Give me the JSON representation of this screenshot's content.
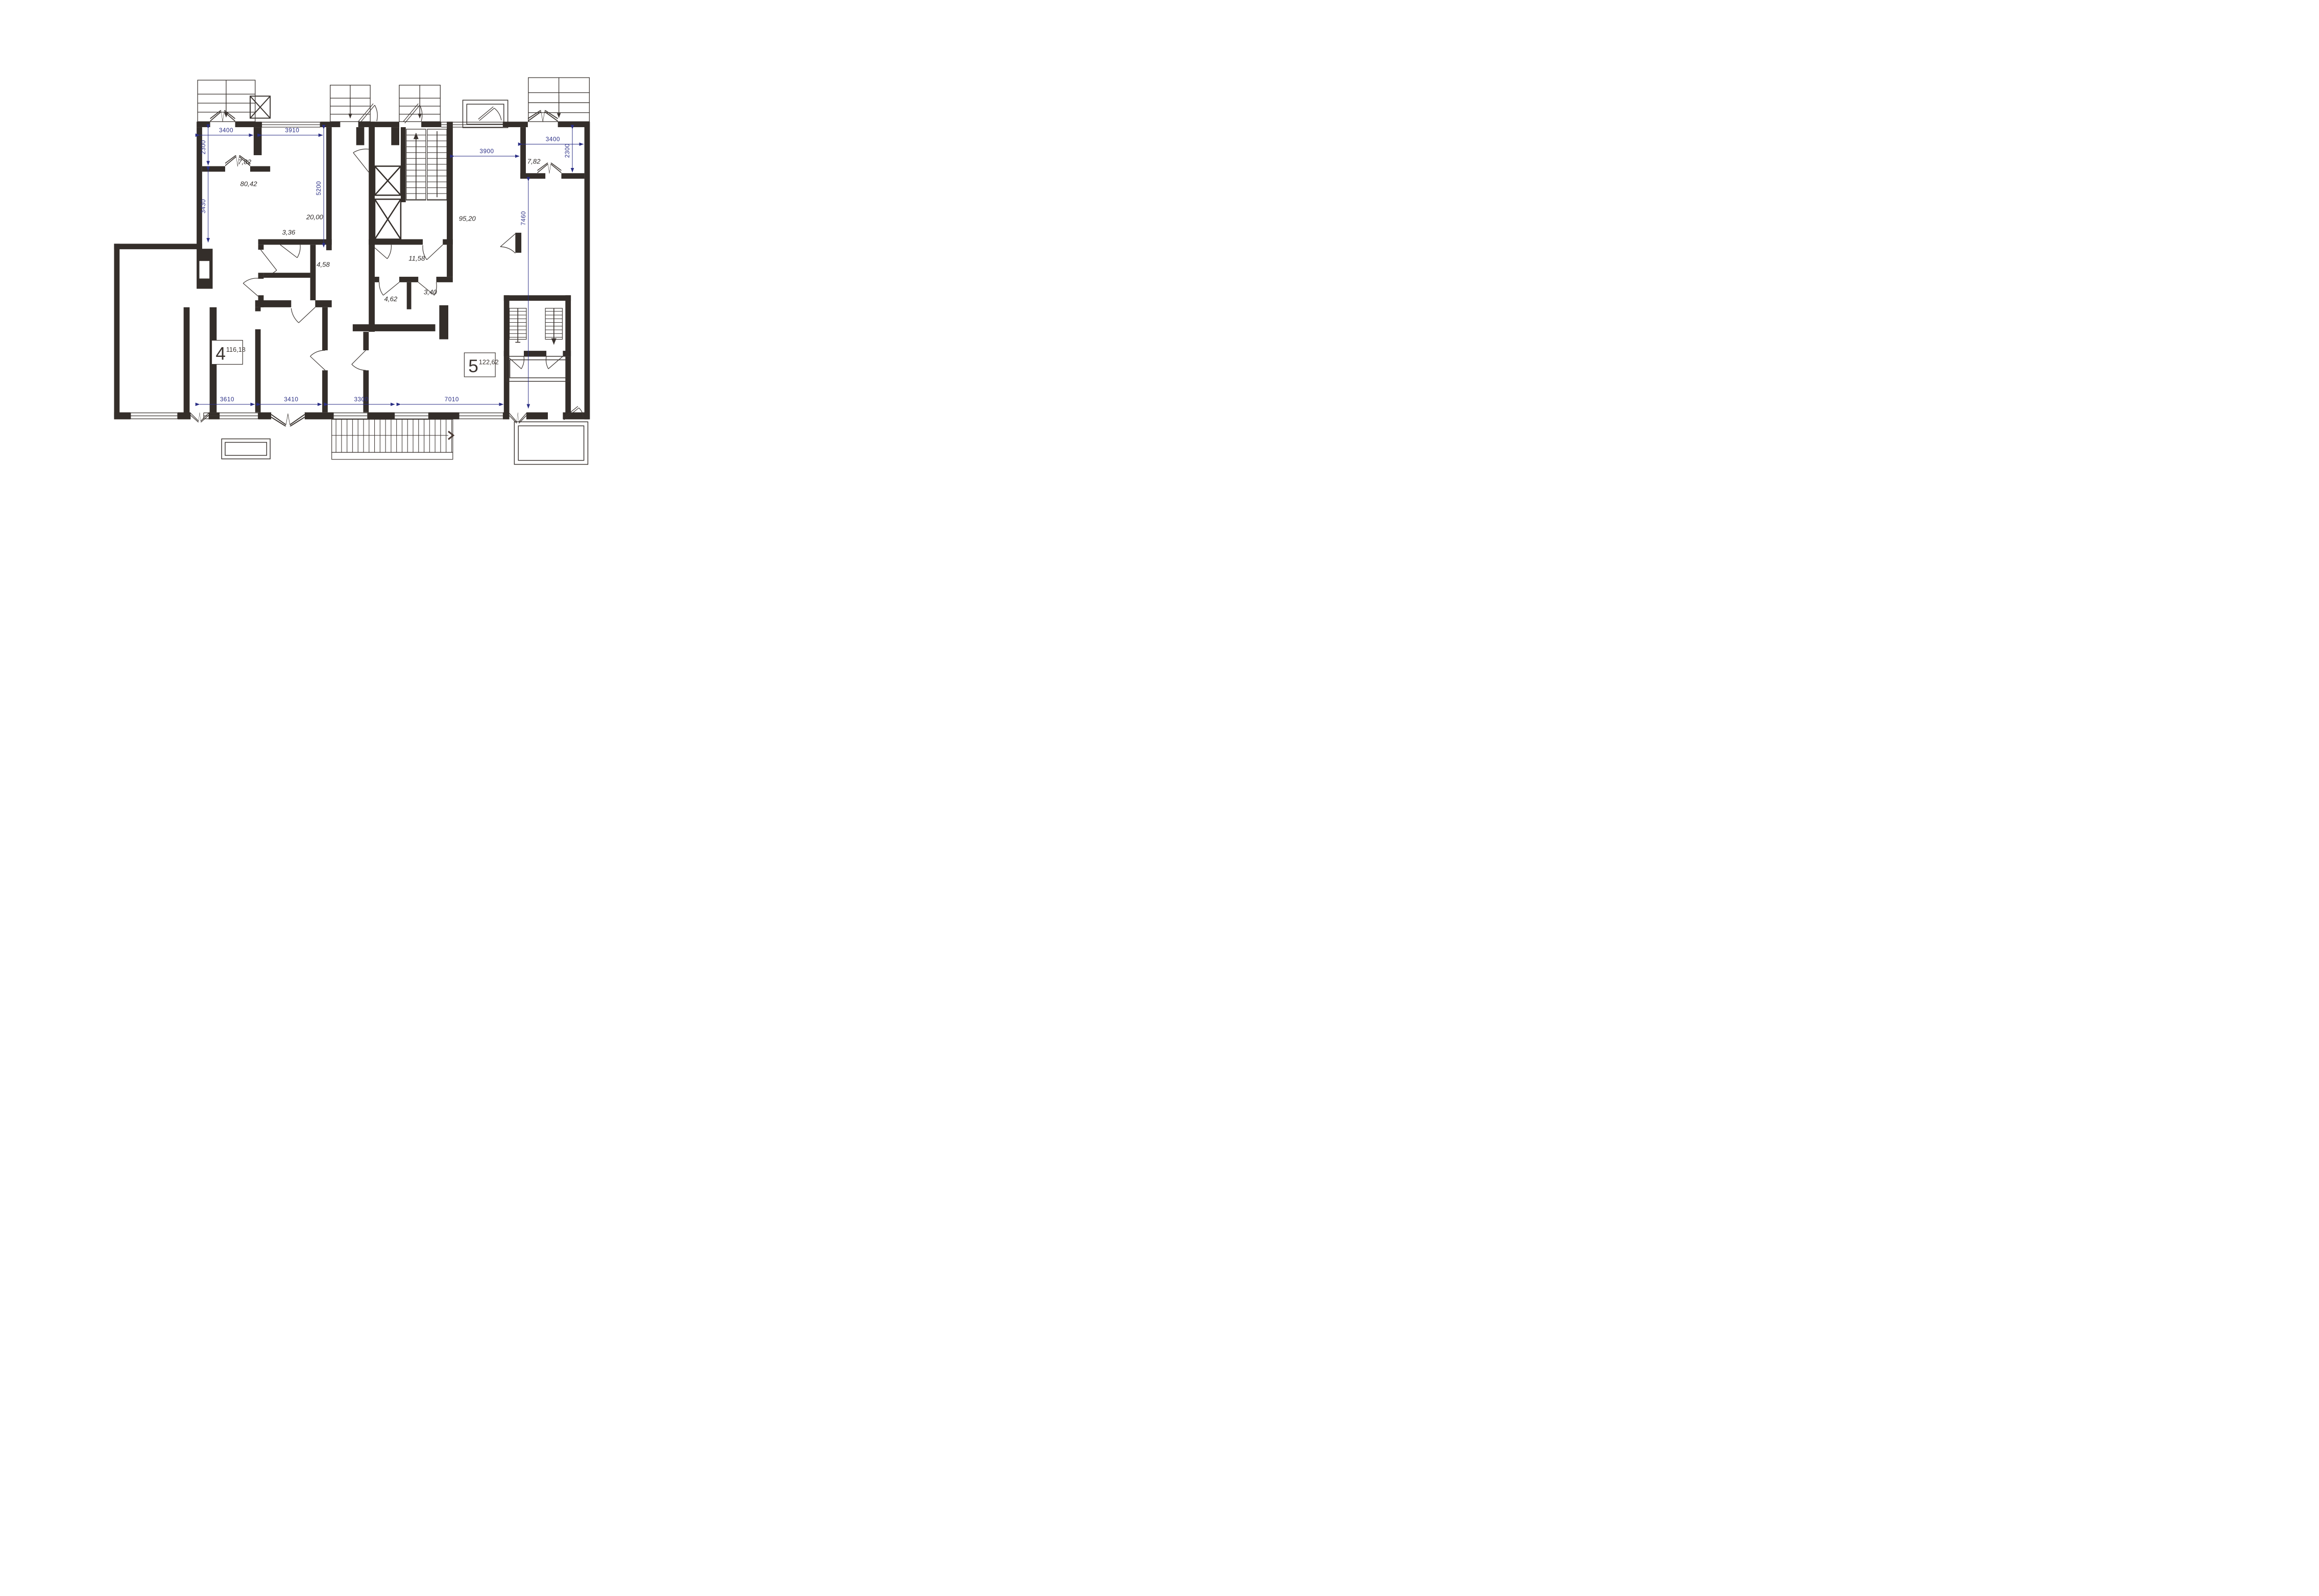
{
  "plan": {
    "title": "apartment-floor-plan",
    "colors": {
      "wall": "#342e2a",
      "thin_line": "#3b3531",
      "dimension": "#2a2e85",
      "label": "#2e2a28",
      "background": "#ffffff"
    },
    "dimensions": {
      "top_left": "3400",
      "top_middle": "3910",
      "left_upper": "2300",
      "left_lower": "3430",
      "kitchen_depth": "5200",
      "hall_width": "3900",
      "right_width": "3400",
      "right_upper": "2300",
      "right_depth": "7460",
      "bottom_1": "3610",
      "bottom_2": "3410",
      "bottom_3": "3300",
      "bottom_4": "7010"
    },
    "rooms": [
      {
        "name": "balcony-room-left",
        "area": "7,82"
      },
      {
        "name": "living-room-large",
        "area": "80,42"
      },
      {
        "name": "kitchen",
        "area": "20,00"
      },
      {
        "name": "bathroom",
        "area": "3,36"
      },
      {
        "name": "hallway-small",
        "area": "4,58"
      },
      {
        "name": "corridor",
        "area": "11,58"
      },
      {
        "name": "living-room-right",
        "area": "95,20"
      },
      {
        "name": "wc",
        "area": "4,62"
      },
      {
        "name": "storage",
        "area": "3,40"
      },
      {
        "name": "balcony-room-right",
        "area": "7,82"
      }
    ],
    "apartments": [
      {
        "number": "4",
        "area": "116,18"
      },
      {
        "number": "5",
        "area": "122,62"
      }
    ]
  }
}
